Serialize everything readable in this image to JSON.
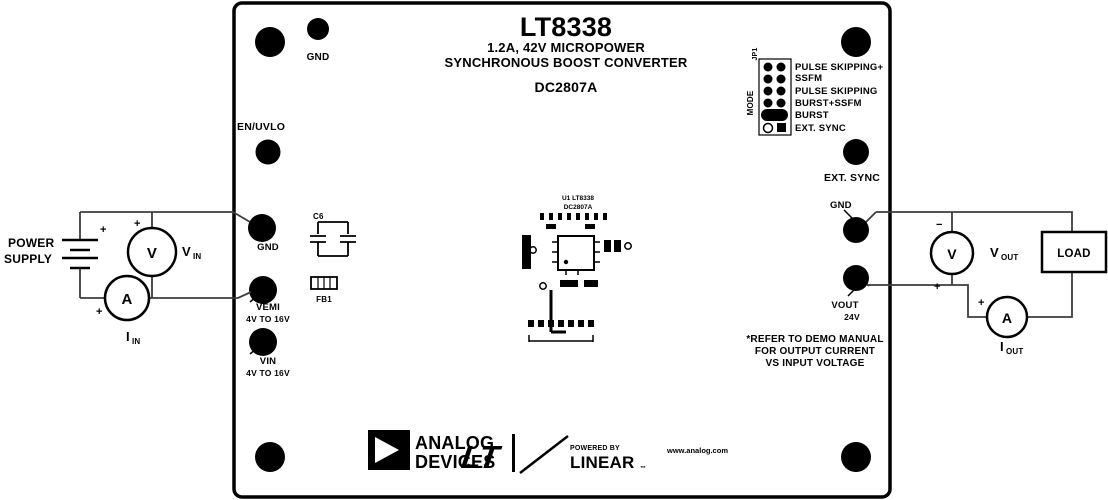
{
  "board": {
    "title": {
      "part": "LT8338",
      "subtitle1": "1.2A, 42V MICROPOWER",
      "subtitle2": "SYNCHRONOUS BOOST CONVERTER",
      "demo_id": "DC2807A"
    },
    "mode_jumper": {
      "designator": "JP1",
      "name": "MODE",
      "positions": [
        "PULSE SKIPPING+",
        "SSFM",
        "PULSE SKIPPING",
        "BURST+SSFM",
        "BURST",
        "EXT. SYNC"
      ]
    },
    "turrets": {
      "gnd_top": "GND",
      "en_uvlo": "EN/UVLO",
      "gnd_left": "GND",
      "vemi": "VEMI",
      "vemi_range": "4V TO 16V",
      "vin": "VIN",
      "vin_range": "4V TO 16V",
      "ext_sync": "EXT. SYNC",
      "gnd_right": "GND",
      "vout": "VOUT",
      "vout_value": "24V"
    },
    "components": {
      "c6": "C6",
      "fb1": "FB1",
      "ic_line1": "U1 LT8338",
      "ic_line2": "DC2807A"
    },
    "note_lines": [
      "*REFER TO DEMO MANUAL",
      "FOR OUTPUT CURRENT",
      "VS INPUT VOLTAGE"
    ],
    "footer": {
      "brand_top": "ANALOG",
      "brand_bottom": "DEVICES",
      "lt_script": "LT",
      "powered_by": "POWERED BY",
      "linear": "LINEAR",
      "tm": "™",
      "website": "www.analog.com"
    }
  },
  "external": {
    "power_supply_line1": "POWER",
    "power_supply_line2": "SUPPLY",
    "load": "LOAD",
    "plus": "+",
    "minus": "−",
    "meters": {
      "volt": "V",
      "amp": "A",
      "vin_sub": "IN",
      "vout_sub": "OUT",
      "iin_i": "I",
      "iout_i": "I"
    }
  },
  "colors": {
    "ink": "#000000",
    "wire": "#3c3c3c",
    "bg": "#ffffff"
  }
}
